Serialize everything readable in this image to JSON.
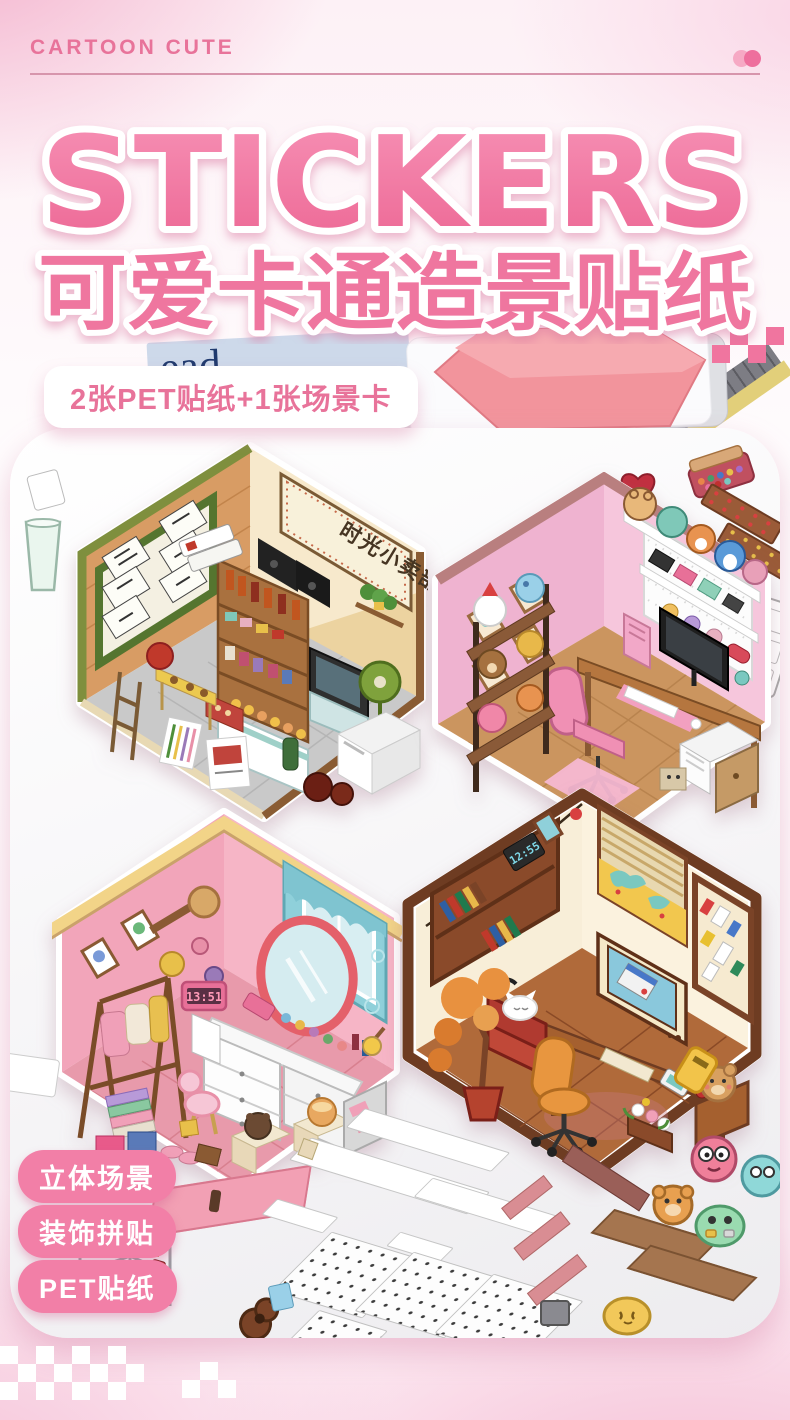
{
  "page": {
    "type": "product-poster",
    "theme": "cartoon cute scene stickers"
  },
  "header": {
    "brand": "CARTOON CUTE"
  },
  "hero": {
    "title": "STICKERS",
    "subtitle": "可爱卡通造景贴纸",
    "badge": "2张PET贴纸+1张场景卡"
  },
  "photo": {
    "book_spine_text": "ead",
    "scenes": [
      {
        "name": "retro corner shop",
        "sign_text": "时光小卖部"
      },
      {
        "name": "pink gamer room"
      },
      {
        "name": "pink vanity room",
        "clock_time": "13:51"
      },
      {
        "name": "cozy study room",
        "clock_time": "12:55"
      }
    ]
  },
  "features": [
    {
      "label": "立体场景"
    },
    {
      "label": "装饰拼贴"
    },
    {
      "label": "PET贴纸"
    }
  ],
  "colors": {
    "accent_pink": "#ee769e",
    "badge_text": "#e8739a",
    "pill_bg": "#f27fa7",
    "heart_red": "#bf2e38",
    "background_pink": "#f5c3d7"
  }
}
